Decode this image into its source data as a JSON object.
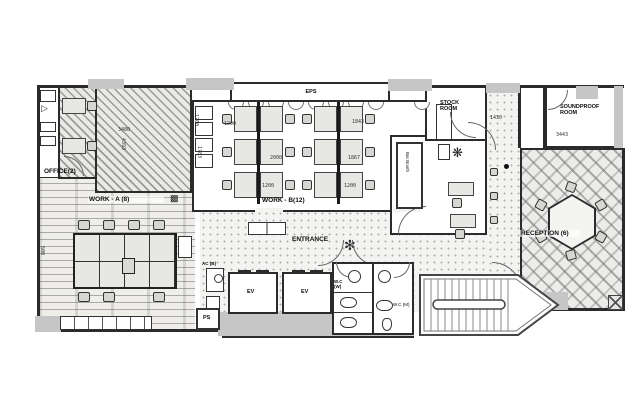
{
  "title": "office-floor-plan",
  "colors": {
    "wall": "#2b2b2b",
    "gray_fill": "#c6c6c6",
    "floor": "#f3f3f1",
    "line": "#555555"
  },
  "rooms": {
    "eps": "EPS",
    "office": "OFFICE(2)",
    "work_a": "WORK - A (8)",
    "work_b": "WORK - B(12)",
    "entrance": "ENTRANCE",
    "stock": "STOCK\nROOM",
    "soundproof": "SOUNDPROOF\nROOM",
    "reception": "RECEPTION (6)",
    "bar_booth": "Bar Booth",
    "ev1": "EV",
    "ev2": "EV",
    "wc_w": "W.C\n(W)",
    "wc_m": "W.C (M)",
    "ac": "AC (B)",
    "ps": "PS"
  },
  "dims": [
    "3480",
    "4393",
    "1200",
    "1783",
    "2000",
    "1867",
    "1843",
    "1200",
    "1200",
    "1430",
    "3443",
    "600",
    "1200"
  ]
}
